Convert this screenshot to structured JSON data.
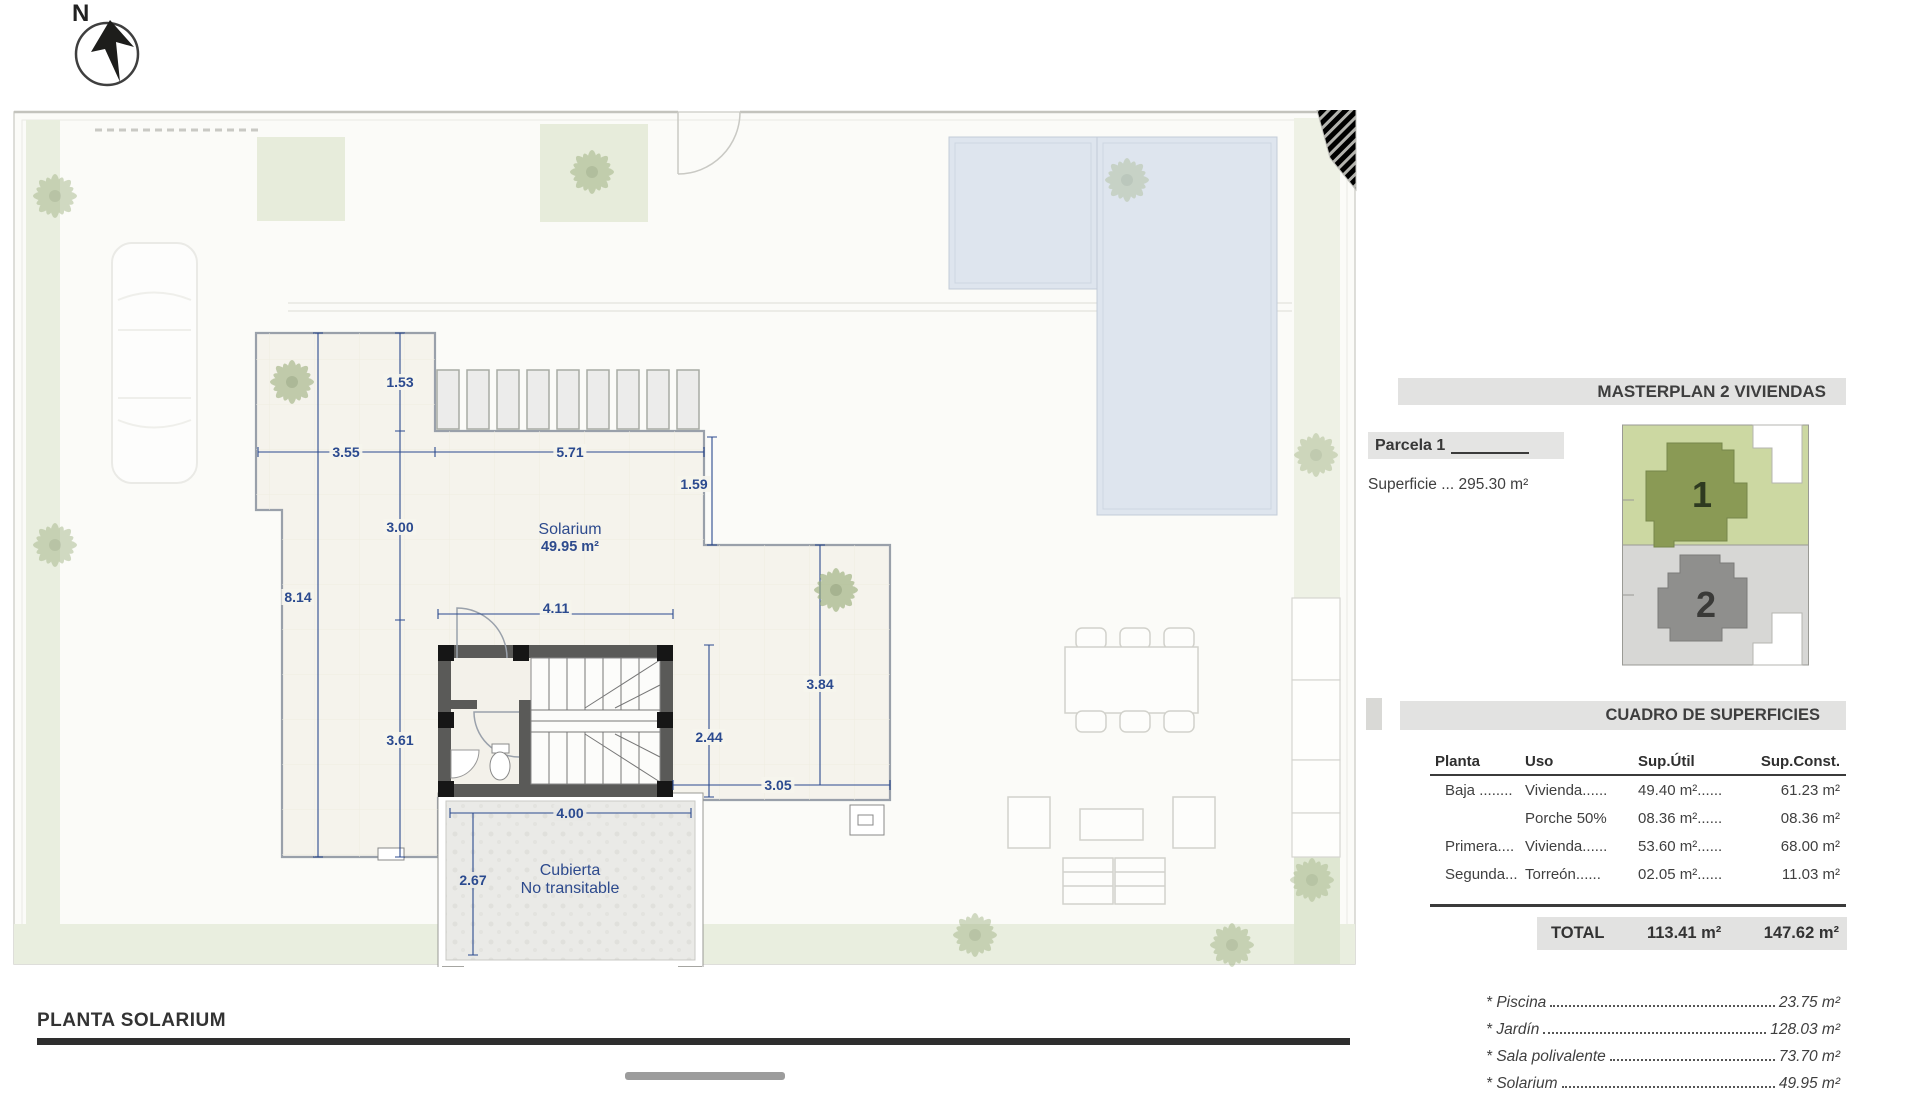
{
  "compass": {
    "label": "N"
  },
  "plan": {
    "title": "PLANTA SOLARIUM",
    "rooms": {
      "solarium": {
        "name": "Solarium",
        "area": "49.95 m²"
      },
      "cubierta": {
        "line1": "Cubierta",
        "line2": "No transitable"
      }
    },
    "dims": {
      "d1_53": "1.53",
      "d3_55": "3.55",
      "d5_71": "5.71",
      "d1_59": "1.59",
      "d3_00": "3.00",
      "d8_14": "8.14",
      "d4_11": "4.11",
      "d2_44": "2.44",
      "d3_84": "3.84",
      "d3_61": "3.61",
      "d3_05": "3.05",
      "d4_00": "4.00",
      "d2_67": "2.67"
    }
  },
  "panel": {
    "title": "MASTERPLAN 2 VIVIENDAS",
    "parcela": {
      "label": "Parcela 1",
      "superficie": "Superficie ... 295.30 m²"
    },
    "siteplan": {
      "plot1": "1",
      "plot2": "2"
    },
    "table": {
      "title": "CUADRO DE SUPERFICIES",
      "headers": [
        "Planta",
        "Uso",
        "Sup.Útil",
        "Sup.Const."
      ],
      "rows": [
        {
          "planta": "Baja ........",
          "uso": "Vivienda......",
          "util": "49.40 m²......",
          "constr": "61.23 m²"
        },
        {
          "planta": "",
          "uso": "Porche 50%",
          "util": "08.36 m²......",
          "constr": "08.36 m²"
        },
        {
          "planta": "Primera....",
          "uso": "Vivienda......",
          "util": "53.60 m²......",
          "constr": "68.00 m²"
        },
        {
          "planta": "Segunda...",
          "uso": "Torreón......",
          "util": "02.05 m²......",
          "constr": "11.03 m²"
        }
      ],
      "total": {
        "label": "TOTAL",
        "util": "113.41 m²",
        "constr": "147.62 m²"
      }
    },
    "extras": [
      {
        "label": "* Piscina",
        "value": "23.75 m²"
      },
      {
        "label": "* Jardín",
        "value": "128.03 m²"
      },
      {
        "label": "* Sala polivalente",
        "value": "73.70 m²"
      },
      {
        "label": "* Solarium",
        "value": "49.95 m²"
      }
    ]
  }
}
